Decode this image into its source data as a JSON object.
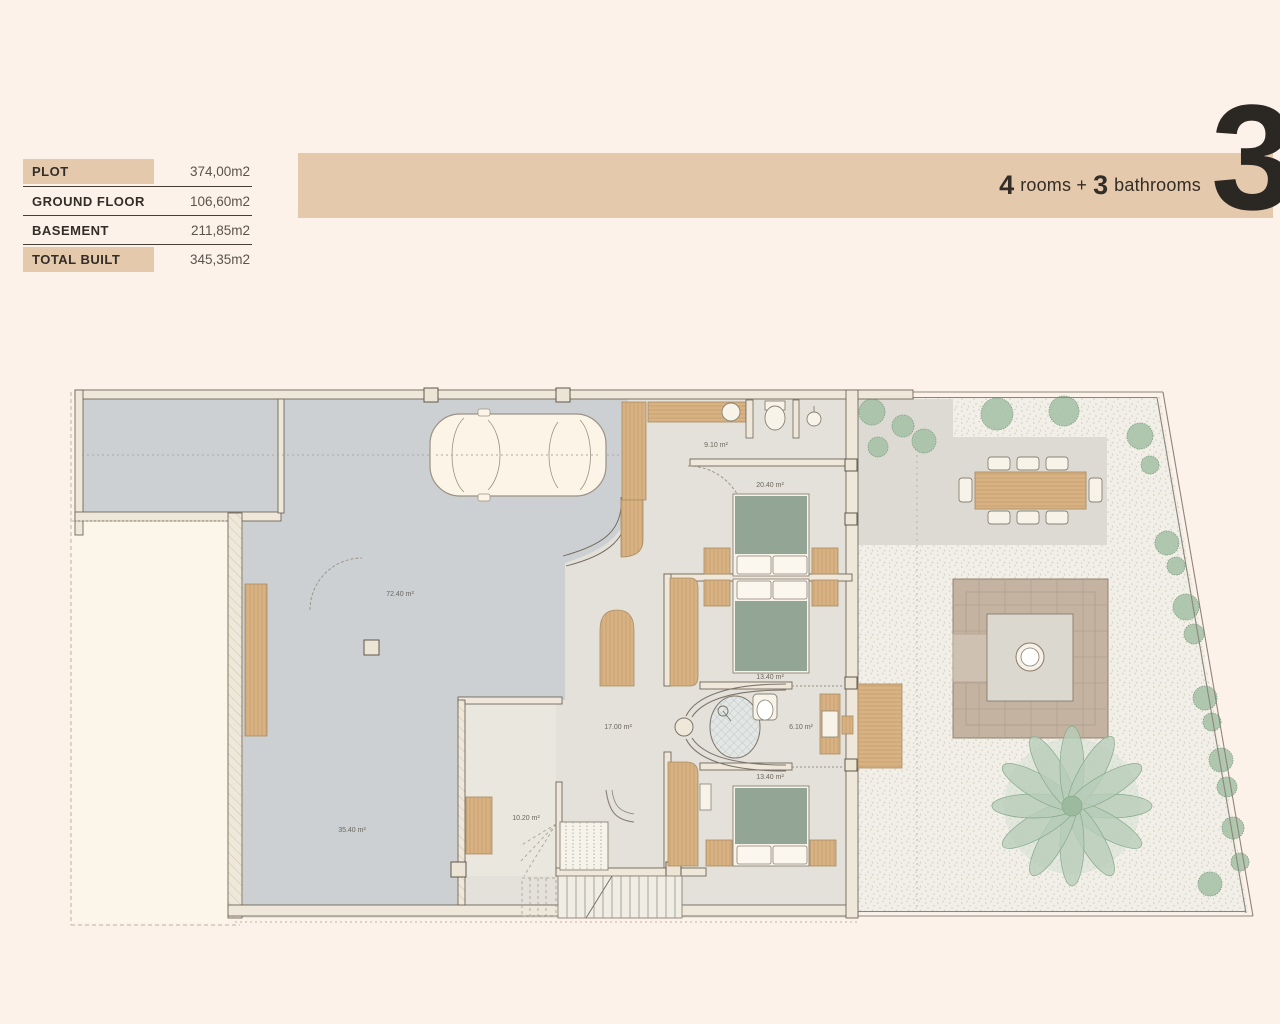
{
  "page": {
    "background_color": "#fdf2ea",
    "accent_color": "#e5c9ad",
    "text_color": "#2b2723"
  },
  "spec_table": {
    "rows": [
      {
        "label": "PLOT",
        "value": "374,00m2",
        "highlight": true
      },
      {
        "label": "GROUND FLOOR",
        "value": "106,60m2",
        "highlight": false
      },
      {
        "label": "BASEMENT",
        "value": "211,85m2",
        "highlight": false
      },
      {
        "label": "TOTAL BUILT",
        "value": "345,35m2",
        "highlight": true
      }
    ]
  },
  "banner": {
    "rooms_value": "4",
    "rooms_label": "rooms +",
    "bathrooms_value": "3",
    "bathrooms_label": "bathrooms",
    "floor_number": "3",
    "color": "#e5c9ad"
  },
  "plan": {
    "area_labels": {
      "garage": "72.40 m²",
      "laundry": "9.10 m²",
      "bedroom_top": "20.40 m²",
      "bedroom_middle": "13.40 m²",
      "bathroom": "6.10 m²",
      "bedroom_bottom": "13.40 m²",
      "hall": "17.00 m²",
      "storage": "10.20 m²",
      "basement_room": "35.40 m²"
    },
    "colors": {
      "concrete_floor": "#ccd0d2",
      "interior_floor": "#e3e1da",
      "gravel": "#f2efe8",
      "terrace": "#dcdad3",
      "pergola": "#c5b3a1",
      "wood": "#d9b284",
      "bed_green": "#93a696",
      "plant_green": "#a3bfa5",
      "wall_line": "#6f6659"
    }
  }
}
